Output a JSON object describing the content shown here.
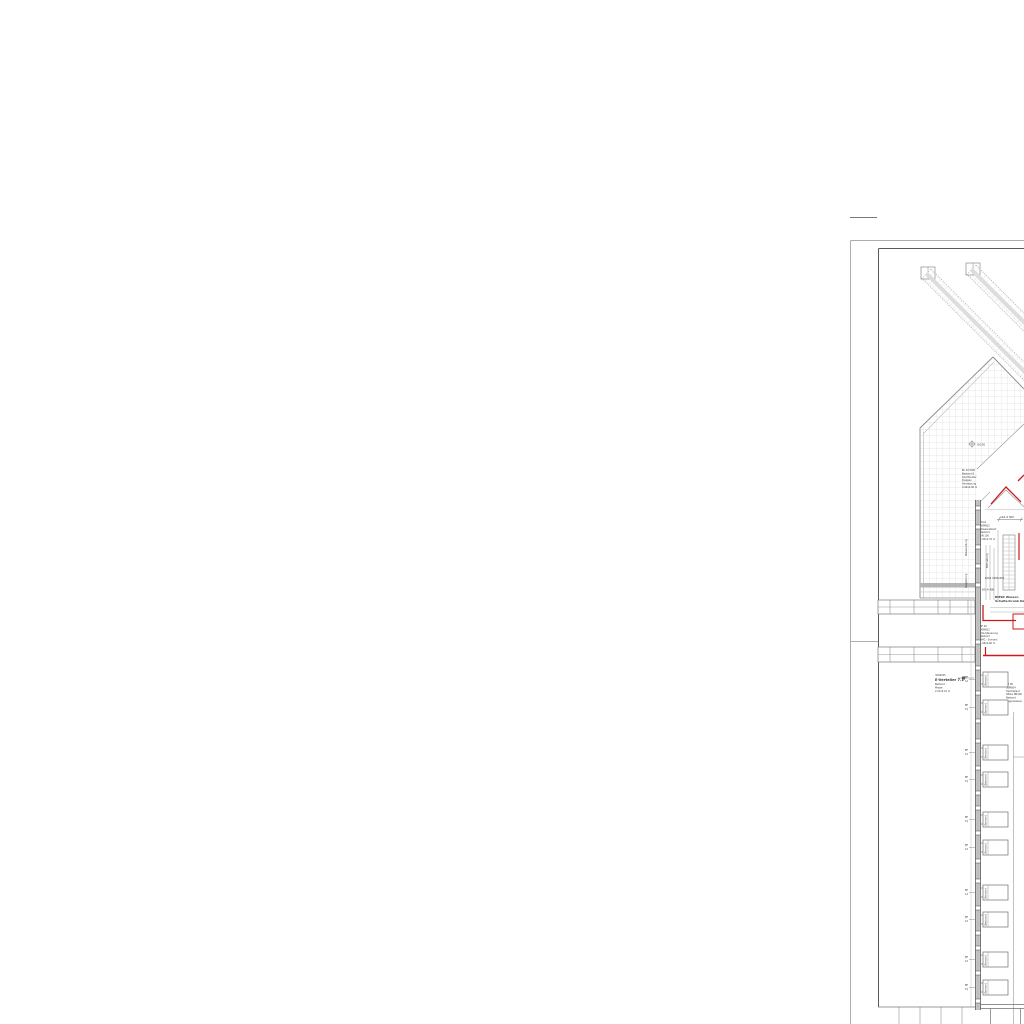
{
  "colors": {
    "line_light": "#b9b9b9",
    "line_mid": "#8c8c8c",
    "line_dark": "#555555",
    "accent_red": "#cc1a1a",
    "grid": "#cfcfcf",
    "eave_band": "#b5b5b5",
    "wall_fill": "#c6c6c6"
  },
  "roof": {
    "survey_point_label": "G026",
    "skylight_note": {
      "lines": [
        "BL 02 W06",
        "Bestand 8",
        "Dachfenster",
        "Klappen",
        "Abmessung",
        "0.94x2.00 m"
      ]
    }
  },
  "center": {
    "level_dim_label": "+64.4 NN",
    "level_label": "65.4 NN",
    "equip_note": {
      "lines": [
        "PCA1",
        "30M602",
        "Wasserablauf",
        "Bestand",
        "DN 100",
        "1.94x2.76 m"
      ]
    },
    "duct_label": "BA04 1950x650",
    "riser_label_left1": "Wasserleitung",
    "riser_label_left2": "Steigleitung",
    "riser_label_right": "BSH Leitung",
    "bmsr_note": {
      "lines": [
        "BMSR Wasser-",
        "Schaltschrank Dach"
      ]
    },
    "lka_note": {
      "lines": [
        "BF 40",
        "30M602",
        "LKA-Steuerung",
        "Bestand",
        "BMC - Schrank",
        "1.96x0.60 m"
      ]
    }
  },
  "wing": {
    "e_note": {
      "lines": [
        "3006025",
        "E-Verteiler 7.1",
        "Bestand",
        "Masse",
        "2.01x2.01 m"
      ]
    }
  },
  "east_note": {
    "lines": [
      "KE 06",
      "30M604",
      "Dachablauf",
      "Attika DN100",
      "Bestand",
      "Regenwasser"
    ]
  },
  "windows": {
    "tick_top": "BF",
    "tick_bottom": "12",
    "labels": [
      "(Fenster)",
      "(Fenster)",
      "(Fenster)",
      "(Bestand)",
      "(Fenster)",
      "(Fenster)",
      "(Fenster)",
      "(Bestand)",
      "(Fenster)",
      "(Fenster)"
    ]
  }
}
